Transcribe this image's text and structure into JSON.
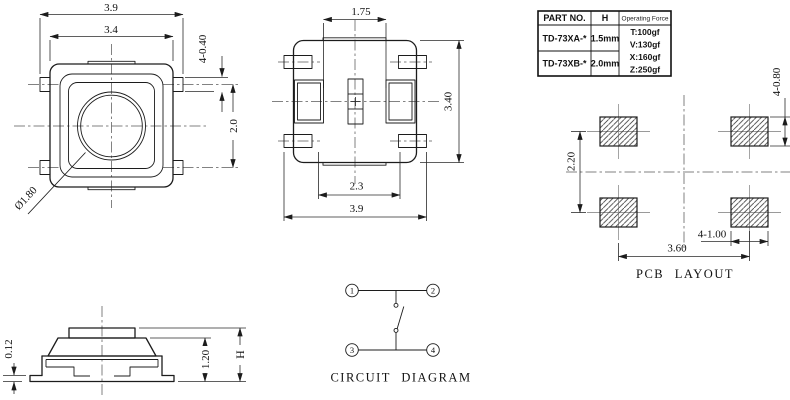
{
  "colors": {
    "line": "#1c1c1c",
    "dimension": "#2a2a2a",
    "centerline": "#5a5a5a",
    "crosshair": "#9a9a9a",
    "background": "#ffffff"
  },
  "spec_table": {
    "headers": [
      "PART NO.",
      "H",
      "Operating Force"
    ],
    "rows": [
      {
        "part_no": "TD-73XA-*",
        "h": "1.5mm"
      },
      {
        "part_no": "TD-73XB-*",
        "h": "2.0mm"
      }
    ],
    "operating_force": [
      "T:100gf",
      "V:130gf",
      "X:160gf",
      "Z:250gf"
    ]
  },
  "top_view": {
    "dim_overall_width": "3.9",
    "dim_body_width": "3.4",
    "dim_lead_width": "4-0.40",
    "dim_lead_span": "2.0",
    "dim_stem_diameter": "Ø1.80"
  },
  "bottom_view": {
    "dim_stem_width": "1.75",
    "dim_body_height": "3.40",
    "dim_inner_span": "2.3",
    "dim_overall_width": "3.9"
  },
  "side_view": {
    "dim_standoff": "0.12",
    "dim_base_height": "1.20",
    "dim_total_height": "H"
  },
  "pcb_layout": {
    "caption": "PCB LAYOUT",
    "dim_pad_height": "4-0.80",
    "dim_row_pitch": "2.20",
    "dim_pad_width": "4-1.00",
    "dim_col_pitch": "3.60"
  },
  "circuit_diagram": {
    "caption": "CIRCUIT DIAGRAM",
    "terminals": [
      "1",
      "2",
      "3",
      "4"
    ]
  }
}
